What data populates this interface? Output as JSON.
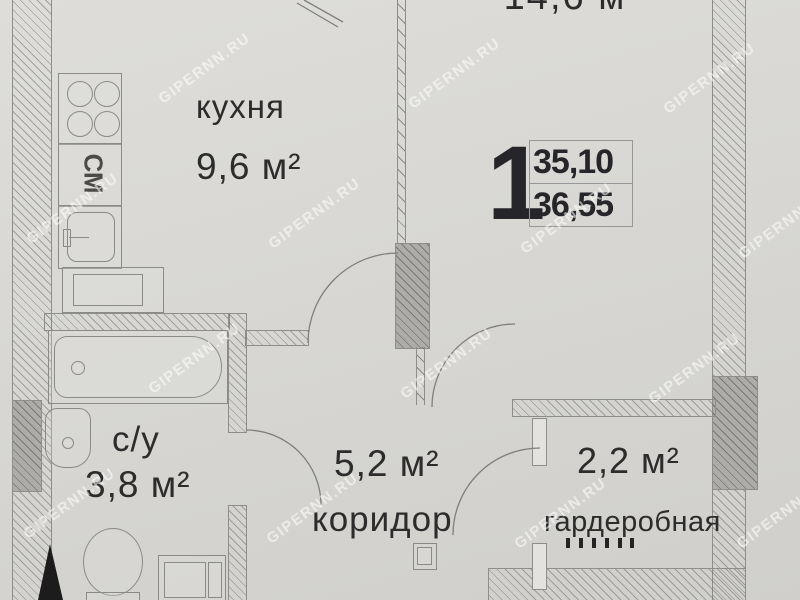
{
  "watermark": {
    "text": "GIPERNN.RU"
  },
  "summary": {
    "rooms_count": "1",
    "area_living": "35,10",
    "area_total": "36,55"
  },
  "rooms": {
    "living": {
      "area_label": "14,6 м"
    },
    "kitchen": {
      "name": "кухня",
      "area_label": "9,6 м²"
    },
    "bathroom": {
      "name": "с/у",
      "area_label": "3,8 м²"
    },
    "corridor": {
      "name": "коридор",
      "area_label": "5,2 м²"
    },
    "wardrobe": {
      "name": "гардеробная",
      "area_label": "2,2 м²"
    }
  },
  "fixtures": {
    "washing_machine_label": "СМ"
  },
  "colors": {
    "paper": "#d8d7d3",
    "line": "#8a8a87",
    "text": "#2c2c2c",
    "wall_dark": "#adaca8",
    "entry_door": "#1c1c1c"
  }
}
